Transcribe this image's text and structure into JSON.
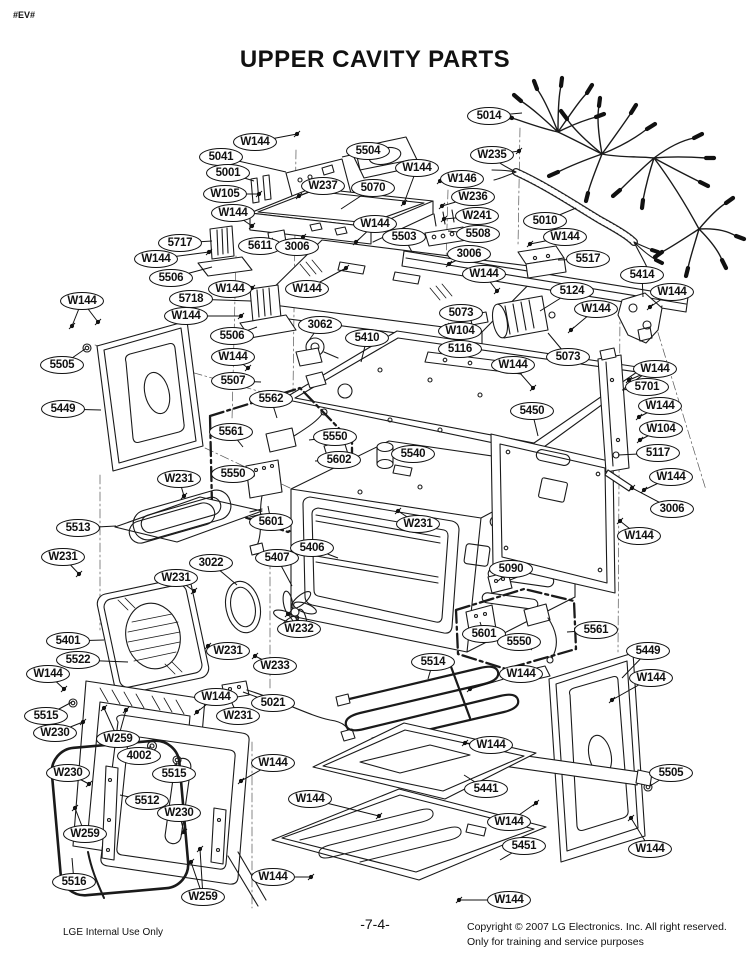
{
  "page": {
    "marker": "#EV#",
    "title": "UPPER CAVITY PARTS",
    "page_number": "-7-4-",
    "footer_left": "LGE Internal Use Only",
    "footer_right_line1": "Copyright © 2007 LG Electronics. Inc. All right reserved.",
    "footer_right_line2": "Only for training and service purposes",
    "colors": {
      "line": "#1a1a1a",
      "paper": "#ffffff"
    }
  },
  "diagram": {
    "description": "Exploded view of upper oven cavity assembly with part callouts",
    "callouts": [
      {
        "label": "W144",
        "x": 255,
        "y": 142,
        "leaders": [
          [
            297,
            134
          ]
        ]
      },
      {
        "label": "5041",
        "x": 221,
        "y": 157,
        "leaders": [
          [
            286,
            172
          ]
        ]
      },
      {
        "label": "5001",
        "x": 228,
        "y": 173,
        "leaders": [
          [
            254,
            181
          ]
        ]
      },
      {
        "label": "5504",
        "x": 368,
        "y": 151,
        "leaders": [
          [
            342,
            157
          ]
        ]
      },
      {
        "label": "W237",
        "x": 323,
        "y": 186,
        "leaders": [
          [
            299,
            196
          ]
        ]
      },
      {
        "label": "5070",
        "x": 373,
        "y": 188,
        "leaders": [
          [
            341,
            209
          ]
        ]
      },
      {
        "label": "W105",
        "x": 225,
        "y": 194,
        "leaders": [
          [
            259,
            194
          ]
        ]
      },
      {
        "label": "W144",
        "x": 233,
        "y": 213,
        "leaders": [
          [
            252,
            226
          ]
        ]
      },
      {
        "label": "5611",
        "x": 260,
        "y": 246,
        "leaders": [
          [
            273,
            238
          ]
        ]
      },
      {
        "label": "3006",
        "x": 297,
        "y": 247,
        "leaders": [
          [
            303,
            237
          ]
        ]
      },
      {
        "label": "W144",
        "x": 375,
        "y": 224,
        "leaders": [
          [
            356,
            242
          ]
        ]
      },
      {
        "label": "5503",
        "x": 404,
        "y": 237,
        "leaders": [
          [
            412,
            252
          ]
        ]
      },
      {
        "label": "W144",
        "x": 417,
        "y": 168,
        "leaders": [
          [
            404,
            203
          ]
        ]
      },
      {
        "label": "5014",
        "x": 489,
        "y": 116,
        "leaders": [
          [
            522,
            113
          ]
        ]
      },
      {
        "label": "W235",
        "x": 492,
        "y": 155,
        "leaders": [
          [
            519,
            151
          ]
        ]
      },
      {
        "label": "W146",
        "x": 462,
        "y": 179,
        "leaders": [
          [
            440,
            181
          ]
        ]
      },
      {
        "label": "W236",
        "x": 473,
        "y": 197,
        "leaders": [
          [
            442,
            206
          ]
        ]
      },
      {
        "label": "W241",
        "x": 477,
        "y": 216,
        "leaders": [
          [
            444,
            219
          ]
        ]
      },
      {
        "label": "5508",
        "x": 478,
        "y": 234,
        "leaders": [
          [
            448,
            231
          ]
        ]
      },
      {
        "label": "5010",
        "x": 545,
        "y": 221,
        "leaders": [
          [
            576,
            208
          ]
        ]
      },
      {
        "label": "3006",
        "x": 469,
        "y": 254,
        "leaders": [
          [
            449,
            264
          ]
        ]
      },
      {
        "label": "W144",
        "x": 565,
        "y": 237,
        "leaders": [
          [
            530,
            244
          ]
        ]
      },
      {
        "label": "5517",
        "x": 588,
        "y": 259,
        "leaders": [
          [
            558,
            260
          ]
        ]
      },
      {
        "label": "W144",
        "x": 484,
        "y": 274,
        "leaders": [
          [
            497,
            291
          ]
        ]
      },
      {
        "label": "5414",
        "x": 642,
        "y": 275,
        "leaders": [
          [
            643,
            297
          ]
        ]
      },
      {
        "label": "W144",
        "x": 672,
        "y": 292,
        "leaders": [
          [
            650,
            307
          ]
        ]
      },
      {
        "label": "5124",
        "x": 572,
        "y": 291,
        "leaders": [
          [
            540,
            311
          ]
        ]
      },
      {
        "label": "W144",
        "x": 596,
        "y": 309,
        "leaders": [
          [
            571,
            330
          ]
        ]
      },
      {
        "label": "5717",
        "x": 180,
        "y": 243,
        "leaders": [
          [
            212,
            241
          ]
        ]
      },
      {
        "label": "W144",
        "x": 156,
        "y": 259,
        "leaders": [
          [
            209,
            252
          ]
        ]
      },
      {
        "label": "5506",
        "x": 171,
        "y": 278,
        "leaders": [
          [
            212,
            267
          ]
        ]
      },
      {
        "label": "W144",
        "x": 230,
        "y": 289,
        "leaders": [
          [
            252,
            288
          ]
        ]
      },
      {
        "label": "W144",
        "x": 307,
        "y": 289,
        "leaders": [
          [
            346,
            268
          ]
        ]
      },
      {
        "label": "5718",
        "x": 191,
        "y": 299,
        "leaders": [
          [
            251,
            301
          ]
        ]
      },
      {
        "label": "W144",
        "x": 186,
        "y": 316,
        "leaders": [
          [
            241,
            316
          ]
        ]
      },
      {
        "label": "5506",
        "x": 232,
        "y": 336,
        "leaders": [
          [
            257,
            327
          ]
        ]
      },
      {
        "label": "W144",
        "x": 82,
        "y": 301,
        "leaders": [
          [
            72,
            326
          ],
          [
            98,
            322
          ]
        ]
      },
      {
        "label": "5505",
        "x": 62,
        "y": 365,
        "leaders": [
          [
            85,
            349
          ]
        ]
      },
      {
        "label": "W144",
        "x": 233,
        "y": 357,
        "leaders": [
          [
            248,
            368
          ]
        ]
      },
      {
        "label": "5507",
        "x": 233,
        "y": 381,
        "leaders": [
          [
            261,
            382
          ]
        ]
      },
      {
        "label": "5449",
        "x": 63,
        "y": 409,
        "leaders": [
          [
            101,
            410
          ]
        ]
      },
      {
        "label": "5562",
        "x": 271,
        "y": 399,
        "leaders": [
          [
            277,
            418
          ]
        ]
      },
      {
        "label": "5561",
        "x": 231,
        "y": 432,
        "leaders": [
          [
            243,
            447
          ]
        ]
      },
      {
        "label": "5550",
        "x": 335,
        "y": 437,
        "leaders": [
          [
            309,
            440
          ]
        ]
      },
      {
        "label": "5602",
        "x": 339,
        "y": 460,
        "leaders": [
          [
            315,
            461
          ]
        ]
      },
      {
        "label": "5550",
        "x": 233,
        "y": 474,
        "leaders": [
          [
            255,
            476
          ]
        ]
      },
      {
        "label": "5601",
        "x": 271,
        "y": 522,
        "leaders": [
          [
            268,
            506
          ]
        ]
      },
      {
        "label": "W231",
        "x": 179,
        "y": 479,
        "leaders": [
          [
            184,
            496
          ]
        ]
      },
      {
        "label": "3062",
        "x": 320,
        "y": 325,
        "leaders": [
          [
            307,
            343
          ]
        ]
      },
      {
        "label": "5410",
        "x": 367,
        "y": 338,
        "leaders": [
          [
            361,
            362
          ]
        ]
      },
      {
        "label": "5073",
        "x": 461,
        "y": 313,
        "leaders": [
          [
            479,
            318
          ]
        ]
      },
      {
        "label": "W104",
        "x": 460,
        "y": 331,
        "leaders": [
          [
            446,
            326
          ]
        ]
      },
      {
        "label": "5116",
        "x": 460,
        "y": 349,
        "leaders": [
          [
            441,
            349
          ]
        ]
      },
      {
        "label": "W144",
        "x": 513,
        "y": 365,
        "leaders": [
          [
            533,
            388
          ]
        ]
      },
      {
        "label": "5073",
        "x": 568,
        "y": 357,
        "leaders": [
          [
            548,
            333
          ]
        ]
      },
      {
        "label": "5450",
        "x": 532,
        "y": 411,
        "leaders": [
          [
            538,
            436
          ]
        ]
      },
      {
        "label": "5540",
        "x": 413,
        "y": 454,
        "leaders": [
          [
            394,
            451
          ]
        ]
      },
      {
        "label": "W231",
        "x": 418,
        "y": 524,
        "leaders": [
          [
            398,
            511
          ]
        ]
      },
      {
        "label": "5406",
        "x": 312,
        "y": 548,
        "leaders": [
          [
            338,
            558
          ]
        ]
      },
      {
        "label": "5407",
        "x": 277,
        "y": 558,
        "leaders": [
          [
            292,
            586
          ]
        ]
      },
      {
        "label": "3022",
        "x": 211,
        "y": 563,
        "leaders": [
          [
            237,
            585
          ]
        ]
      },
      {
        "label": "W231",
        "x": 176,
        "y": 578,
        "leaders": [
          [
            194,
            591
          ]
        ]
      },
      {
        "label": "5513",
        "x": 78,
        "y": 528,
        "leaders": [
          [
            116,
            526
          ]
        ]
      },
      {
        "label": "W231",
        "x": 63,
        "y": 557,
        "leaders": [
          [
            79,
            574
          ]
        ]
      },
      {
        "label": "5090",
        "x": 511,
        "y": 569,
        "leaders": [
          [
            498,
            581
          ]
        ]
      },
      {
        "label": "W144",
        "x": 655,
        "y": 369,
        "leaders": [
          [
            629,
            380
          ]
        ]
      },
      {
        "label": "5701",
        "x": 647,
        "y": 387,
        "leaders": [
          [
            622,
            390
          ]
        ]
      },
      {
        "label": "W144",
        "x": 660,
        "y": 406,
        "leaders": [
          [
            639,
            417
          ]
        ]
      },
      {
        "label": "W104",
        "x": 661,
        "y": 429,
        "leaders": [
          [
            640,
            440
          ]
        ]
      },
      {
        "label": "5117",
        "x": 658,
        "y": 453,
        "leaders": [
          [
            618,
            455
          ]
        ]
      },
      {
        "label": "W144",
        "x": 671,
        "y": 477,
        "leaders": [
          [
            644,
            490
          ]
        ]
      },
      {
        "label": "3006",
        "x": 672,
        "y": 509,
        "leaders": [
          [
            632,
            488
          ]
        ]
      },
      {
        "label": "W144",
        "x": 639,
        "y": 536,
        "leaders": [
          [
            620,
            521
          ]
        ]
      },
      {
        "label": "5401",
        "x": 68,
        "y": 641,
        "leaders": [
          [
            104,
            640
          ]
        ]
      },
      {
        "label": "5522",
        "x": 78,
        "y": 660,
        "leaders": [
          [
            128,
            662
          ]
        ]
      },
      {
        "label": "W231",
        "x": 228,
        "y": 651,
        "leaders": [
          [
            208,
            646
          ]
        ]
      },
      {
        "label": "W233",
        "x": 275,
        "y": 666,
        "leaders": [
          [
            255,
            656
          ]
        ]
      },
      {
        "label": "W232",
        "x": 299,
        "y": 629,
        "leaders": [
          [
            288,
            614
          ]
        ]
      },
      {
        "label": "W144",
        "x": 216,
        "y": 697,
        "leaders": [
          [
            197,
            712
          ]
        ]
      },
      {
        "label": "5021",
        "x": 273,
        "y": 703,
        "leaders": [
          [
            243,
            692
          ]
        ]
      },
      {
        "label": "W231",
        "x": 238,
        "y": 716,
        "leaders": [
          [
            231,
            701
          ]
        ]
      },
      {
        "label": "5514",
        "x": 433,
        "y": 662,
        "leaders": [
          [
            428,
            679
          ]
        ]
      },
      {
        "label": "5601",
        "x": 484,
        "y": 634,
        "leaders": [
          [
            480,
            622
          ]
        ]
      },
      {
        "label": "5550",
        "x": 519,
        "y": 642,
        "leaders": [
          [
            532,
            650
          ]
        ]
      },
      {
        "label": "5561",
        "x": 596,
        "y": 630,
        "leaders": [
          [
            567,
            632
          ]
        ]
      },
      {
        "label": "W144",
        "x": 521,
        "y": 674,
        "leaders": [
          [
            470,
            689
          ]
        ]
      },
      {
        "label": "5449",
        "x": 648,
        "y": 651,
        "leaders": [
          [
            622,
            678
          ]
        ]
      },
      {
        "label": "W144",
        "x": 651,
        "y": 678,
        "leaders": [
          [
            612,
            700
          ]
        ]
      },
      {
        "label": "W144",
        "x": 48,
        "y": 674,
        "leaders": [
          [
            64,
            689
          ]
        ]
      },
      {
        "label": "5515",
        "x": 46,
        "y": 716,
        "leaders": [
          [
            72,
            702
          ]
        ]
      },
      {
        "label": "W230",
        "x": 55,
        "y": 733,
        "leaders": [
          [
            83,
            722
          ]
        ]
      },
      {
        "label": "W259",
        "x": 118,
        "y": 739,
        "leaders": [
          [
            104,
            708
          ],
          [
            126,
            710
          ]
        ]
      },
      {
        "label": "4002",
        "x": 139,
        "y": 756,
        "leaders": [
          [
            151,
            746
          ]
        ]
      },
      {
        "label": "5515",
        "x": 174,
        "y": 774,
        "leaders": [
          [
            177,
            762
          ]
        ]
      },
      {
        "label": "W230",
        "x": 68,
        "y": 773,
        "leaders": [
          [
            89,
            784
          ]
        ]
      },
      {
        "label": "5512",
        "x": 147,
        "y": 801,
        "leaders": [
          [
            120,
            795
          ]
        ]
      },
      {
        "label": "W230",
        "x": 179,
        "y": 813,
        "leaders": [
          [
            184,
            832
          ]
        ]
      },
      {
        "label": "W259",
        "x": 85,
        "y": 834,
        "leaders": [
          [
            75,
            808
          ]
        ]
      },
      {
        "label": "5516",
        "x": 74,
        "y": 882,
        "leaders": [
          [
            72,
            858
          ]
        ]
      },
      {
        "label": "W144",
        "x": 273,
        "y": 763,
        "leaders": [
          [
            241,
            781
          ]
        ]
      },
      {
        "label": "W144",
        "x": 310,
        "y": 799,
        "leaders": [
          [
            379,
            816
          ]
        ]
      },
      {
        "label": "W144",
        "x": 491,
        "y": 745,
        "leaders": [
          [
            465,
            743
          ]
        ]
      },
      {
        "label": "5441",
        "x": 486,
        "y": 789,
        "leaders": [
          [
            464,
            775
          ]
        ]
      },
      {
        "label": "5505",
        "x": 671,
        "y": 773,
        "leaders": [
          [
            650,
            786
          ]
        ]
      },
      {
        "label": "W144",
        "x": 273,
        "y": 877,
        "leaders": [
          [
            311,
            877
          ]
        ]
      },
      {
        "label": "W259",
        "x": 203,
        "y": 897,
        "leaders": [
          [
            191,
            862
          ],
          [
            200,
            849
          ]
        ]
      },
      {
        "label": "W144",
        "x": 509,
        "y": 822,
        "leaders": [
          [
            536,
            803
          ]
        ]
      },
      {
        "label": "5451",
        "x": 524,
        "y": 846,
        "leaders": [
          [
            500,
            860
          ]
        ]
      },
      {
        "label": "W144",
        "x": 650,
        "y": 849,
        "leaders": [
          [
            631,
            818
          ]
        ]
      },
      {
        "label": "W144",
        "x": 509,
        "y": 900,
        "leaders": [
          [
            459,
            900
          ]
        ]
      }
    ]
  }
}
